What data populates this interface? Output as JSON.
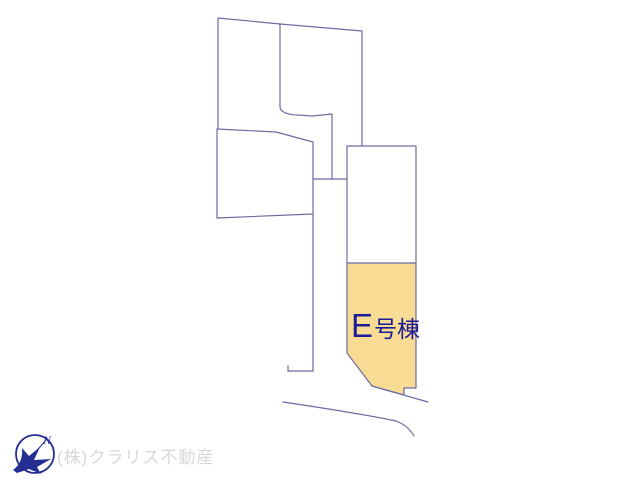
{
  "colors": {
    "background": "#ffffff",
    "line": "#6b6ba3",
    "parcel-fill": "#f9dc94",
    "label-text": "#1c1c96",
    "watermark-text": "#d8d8d8",
    "compass": "#232d92"
  },
  "map": {
    "type": "real-estate-site-plan",
    "highlighted_parcel": {
      "label_main": "E",
      "label_suffix": "号棟"
    },
    "compass": {
      "north_label": "N"
    },
    "watermark": "(株)クラリス不動産"
  }
}
